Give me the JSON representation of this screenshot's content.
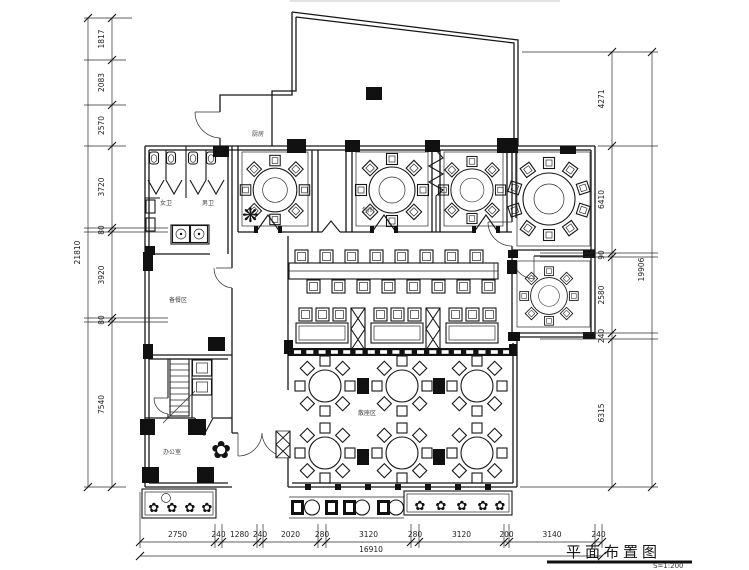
{
  "title": {
    "text": "平面布置图",
    "scale": "S=1:200"
  },
  "dims": {
    "left": {
      "total": "21810",
      "segments": [
        "1817",
        "2083",
        "2570",
        "3720",
        "80",
        "3920",
        "80",
        "7540"
      ]
    },
    "right": {
      "total": "19906",
      "segments": [
        "4271",
        "6410",
        "90",
        "2580",
        "240",
        "6315"
      ]
    },
    "bottom": {
      "total": "16910",
      "segments": [
        "2750",
        "240",
        "1280",
        "240",
        "2020",
        "280",
        "3120",
        "280",
        "3120",
        "200",
        "3140",
        "240"
      ]
    }
  },
  "labels": {
    "kitchen": "厨房",
    "wc_women": "女卫",
    "wc_men": "男卫",
    "prep_room": "备餐区",
    "office": "办公室",
    "dining_hall": "散座区",
    "private_room": "包间"
  },
  "icons": {
    "plant": "✿",
    "fan": "❋"
  },
  "colors": {
    "line": "#161616",
    "background": "#ffffff"
  }
}
